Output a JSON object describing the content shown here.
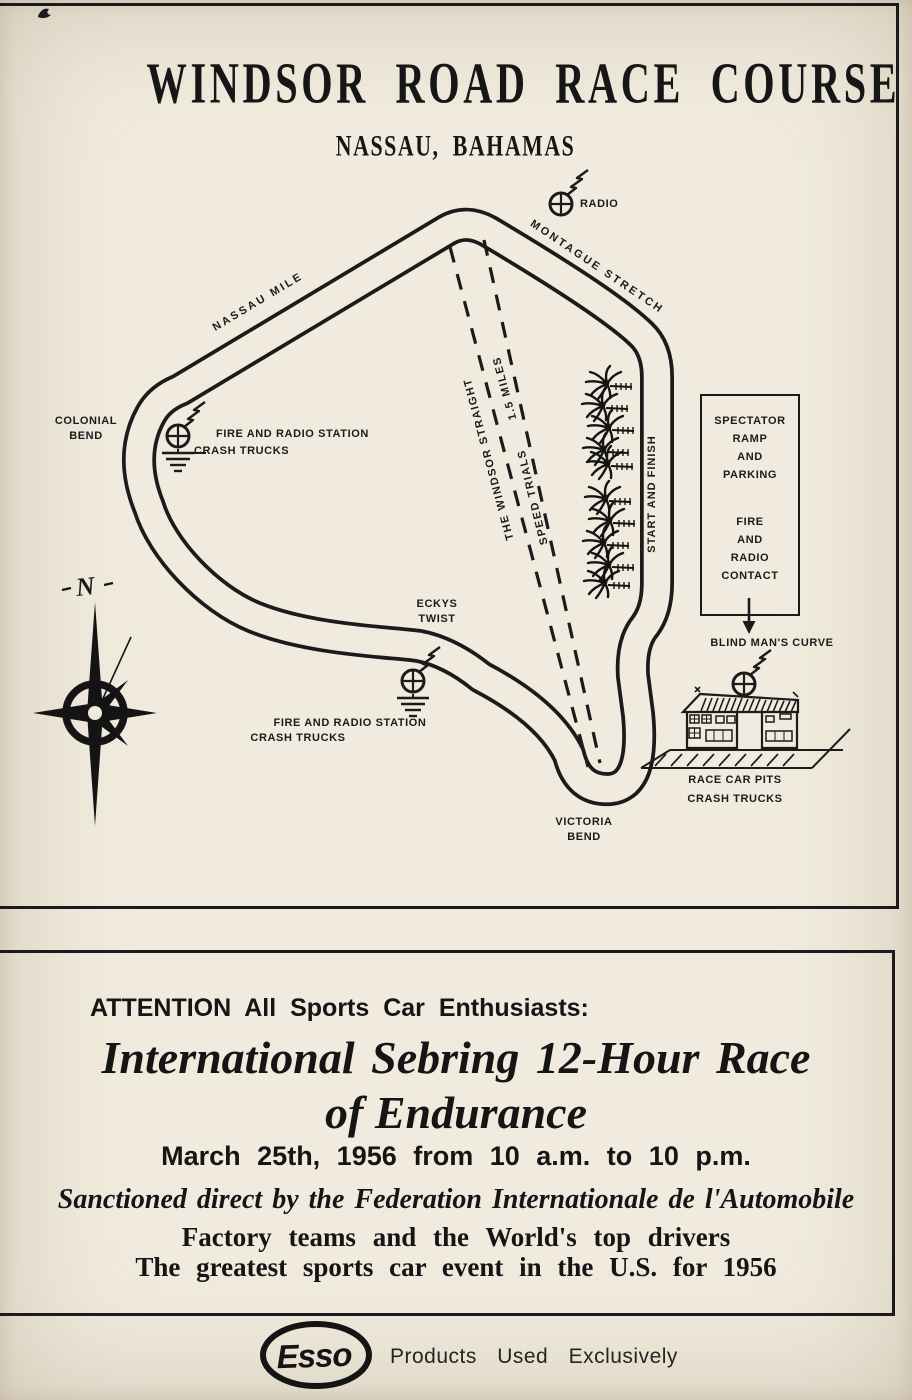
{
  "header": {
    "title": "WINDSOR ROAD RACE COURSE",
    "subtitle": "NASSAU, BAHAMAS"
  },
  "map": {
    "radio": "RADIO",
    "montague_stretch": "MONTAGUE STRETCH",
    "nassau_mile": "NASSAU MILE",
    "colonial_bend": [
      "COLONIAL",
      "BEND"
    ],
    "station_west": [
      "FIRE AND RADIO STATION",
      "CRASH TRUCKS"
    ],
    "windsor_straight": "THE WINDSOR STRAIGHT",
    "windsor_length": "1.5 MILES",
    "speed_trials": "SPEED TRIALS",
    "start_finish": "START AND FINISH",
    "spectator_box": [
      "SPECTATOR",
      "RAMP",
      "AND",
      "PARKING",
      "FIRE",
      "AND",
      "RADIO",
      "CONTACT"
    ],
    "blind_mans_curve": "BLIND MAN'S CURVE",
    "eckys_twist": [
      "ECKYS",
      "TWIST"
    ],
    "station_south": [
      "FIRE AND RADIO STATION",
      "CRASH TRUCKS"
    ],
    "victoria_bend": [
      "VICTORIA",
      "BEND"
    ],
    "race_car_pits": [
      "RACE CAR PITS",
      "CRASH TRUCKS"
    ],
    "compass_north": "N"
  },
  "ad": {
    "attention": "ATTENTION All Sports Car Enthusiasts:",
    "headline": [
      "International Sebring 12-Hour Race",
      "of Endurance"
    ],
    "date_line": "March 25th, 1956 from 10 a.m. to 10 p.m.",
    "sanction_line": "Sanctioned direct by the Federation Internationale de l'Automobile",
    "teams_line": "Factory teams and the World's top drivers",
    "event_line": "The greatest sports car event in the U.S. for 1956"
  },
  "footer": {
    "esso": "Esso",
    "tagline": "Products Used Exclusively"
  },
  "colors": {
    "paper": "#f0ebde",
    "ink": "#1b1b1b"
  }
}
